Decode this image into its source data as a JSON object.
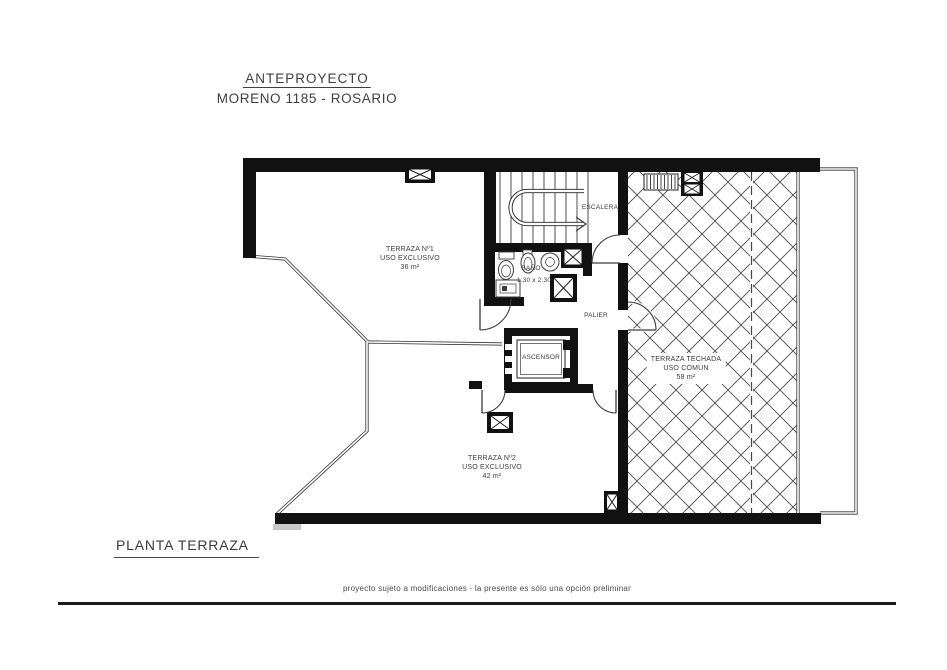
{
  "document": {
    "project_title": "ANTEPROYECTO",
    "project_subtitle": "MORENO 1185 - ROSARIO",
    "plan_name": "PLANTA TERRAZA",
    "disclaimer": "proyecto sujeto a modificaciones - la presente es sólo una opción preliminar"
  },
  "plan": {
    "rooms": {
      "terraza1": {
        "name": "TERRAZA Nº1",
        "use": "USO EXCLUSIVO",
        "area": "36 m²"
      },
      "terraza2": {
        "name": "TERRAZA Nº2",
        "use": "USO EXCLUSIVO",
        "area": "42 m²"
      },
      "terrazaTechada": {
        "name": "TERRAZA TECHADA",
        "use": "USO COMÚN",
        "area": "58 m²"
      },
      "escalera": {
        "name": "ESCALERA"
      },
      "banio": {
        "name": "BAÑO",
        "dimensions": "1.30 x 2.30"
      },
      "palier": {
        "name": "PALIER"
      },
      "ascensor": {
        "name": "ASCENSOR"
      }
    },
    "colors": {
      "wall": "#111111",
      "thin_line": "#3c3c3c",
      "hatch": "#4a4a4a",
      "text": "#3a3a3a"
    }
  }
}
